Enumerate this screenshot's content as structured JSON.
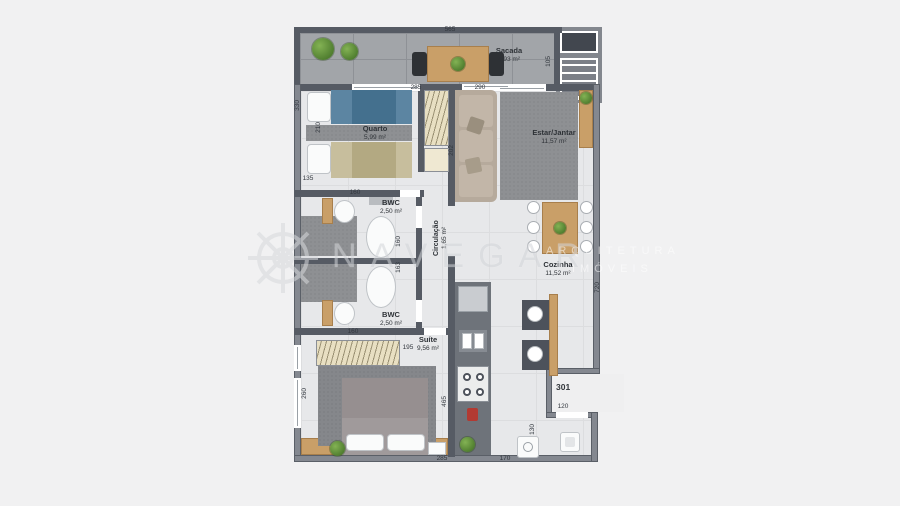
{
  "unit": {
    "number": "301"
  },
  "watermark": {
    "brand": "NAVEGAR",
    "tagline_line1": "ARQUITETURA",
    "tagline_line2": "IMÓVEIS"
  },
  "rooms": {
    "sacada": {
      "name": "Sacada",
      "area": "5,93 m²"
    },
    "quarto": {
      "name": "Quarto",
      "area": "5,99 m²"
    },
    "estar": {
      "name": "Estar/Jantar",
      "area": "11,57 m²"
    },
    "bwc1": {
      "name": "BWC",
      "area": "2,50 m²"
    },
    "circulacao": {
      "name": "Circulação",
      "area": "1,65 m²"
    },
    "bwc2": {
      "name": "BWC",
      "area": "2,50 m²"
    },
    "cozinha": {
      "name": "Cozinha",
      "area": "11,52 m²"
    },
    "suite": {
      "name": "Suíte",
      "area": "9,56 m²"
    }
  },
  "dims": {
    "balcony_width": "565",
    "quarto_width": "285",
    "estar_width": "290",
    "stairs_height": "105",
    "left_upper": "330",
    "quarto_height": "210",
    "left_lower": "135",
    "bwc1_width": "160",
    "bwc1_depth": "160",
    "bwc2_depth": "163",
    "sofa_wall": "202",
    "kitchen_height": "720",
    "bwc2_width": "160",
    "closet_width": "195",
    "suite_height": "260",
    "suite_wall": "465",
    "suite_width": "285",
    "service_width": "170",
    "entry_width": "120",
    "entry_depth": "130"
  }
}
